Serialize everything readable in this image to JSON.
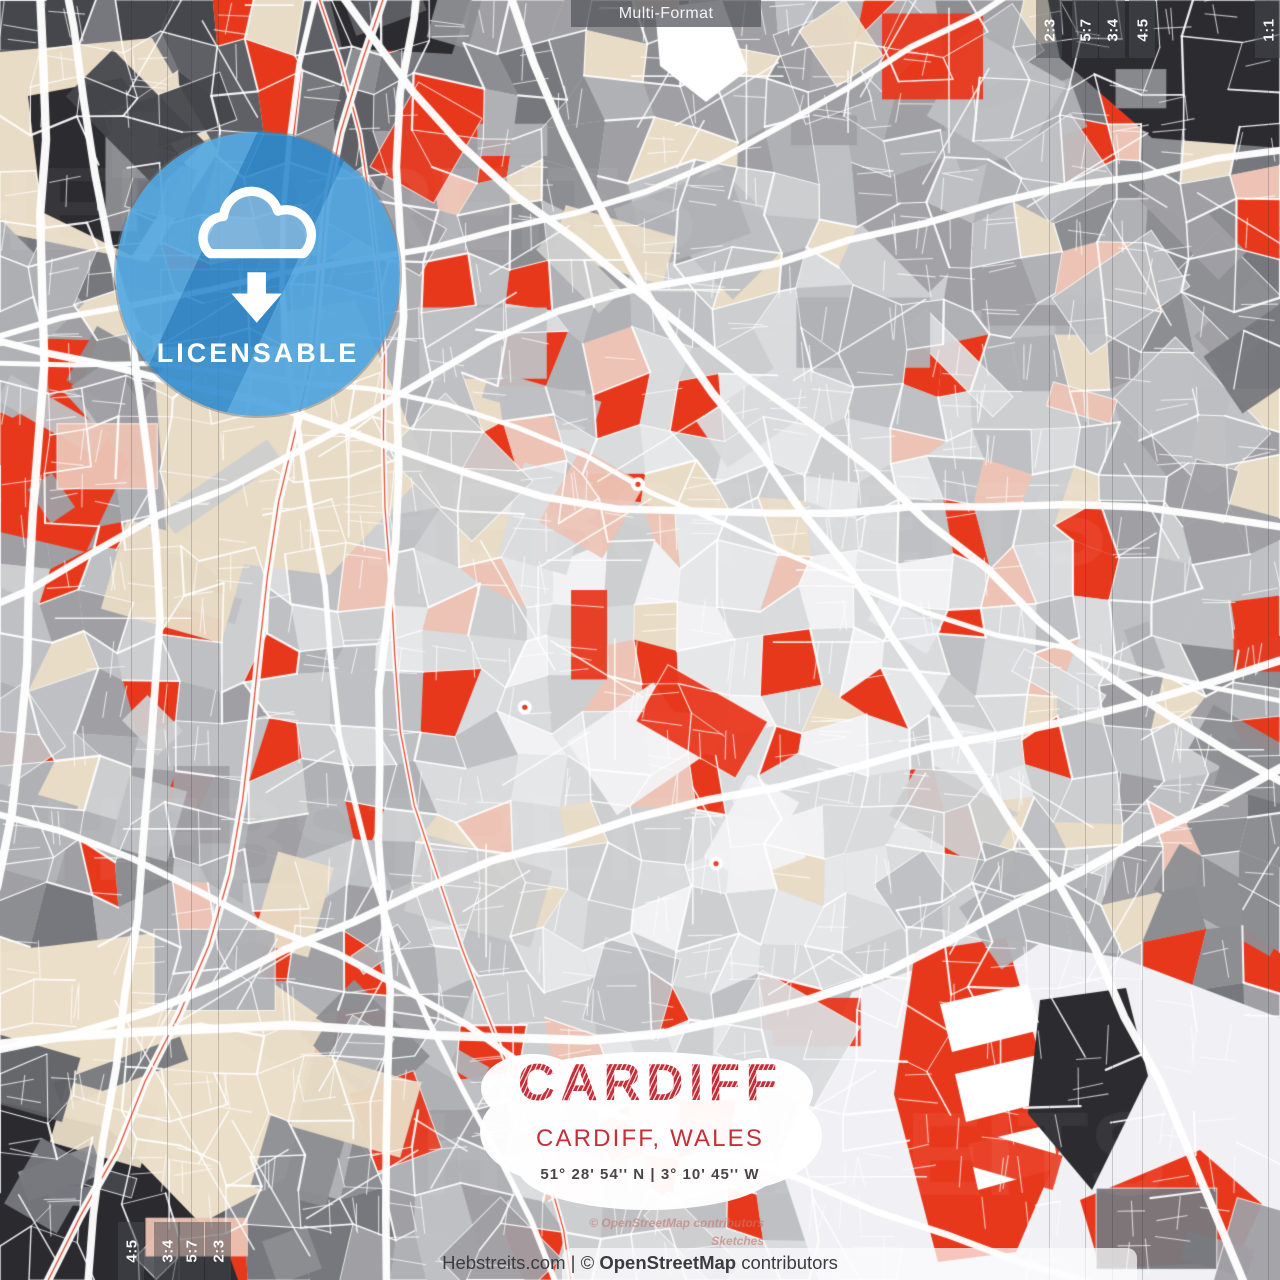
{
  "top_bar": {
    "label": "Multi-Format"
  },
  "badge": {
    "label": "LICENSABLE",
    "icon": "cloud-download-icon",
    "circle_color_rgba": "rgba(50,145,212,0.87)"
  },
  "title_block": {
    "title": "CARDIFF",
    "subtitle": "CARDIFF, WALES",
    "coordinates": "51° 28' 54'' N | 3° 10' 45'' W",
    "accent_color": "#c4303a",
    "coords_color": "#4a4449"
  },
  "footer": {
    "site": "Hebstreits.com",
    "separator": " | ",
    "copyright_prefix": "© ",
    "copyright_brand": "OpenStreetMap",
    "copyright_suffix": " contributors"
  },
  "attribution": {
    "line1": "© OpenStreetMap contributors",
    "line2": "Sketches"
  },
  "watermark": {
    "text": "HEBSTREITS"
  },
  "crop_guides": {
    "right": [
      {
        "label": "2:3",
        "x": 1049
      },
      {
        "label": "5:7",
        "x": 1085
      },
      {
        "label": "3:4",
        "x": 1112
      },
      {
        "label": "4:5",
        "x": 1142
      },
      {
        "label": "1:1",
        "x": 1268
      }
    ],
    "left": [
      {
        "label": "4:5",
        "x": 131
      },
      {
        "label": "3:4",
        "x": 167
      },
      {
        "label": "5:7",
        "x": 191
      },
      {
        "label": "2:3",
        "x": 218
      }
    ]
  },
  "map": {
    "seed": 11,
    "base": "#d4d5d7",
    "grid": 30,
    "jitter": 30,
    "p_red": 0.085,
    "p_warm": 0.1,
    "palette": {
      "red": "#e8381c",
      "beige": "#e9dcc6",
      "pink": "#ecc3b4",
      "street": "#ffffff",
      "grays": [
        "#ffffff",
        "#f2f2f4",
        "#e6e7e9",
        "#dadbdd",
        "#cdcecf",
        "#bfc0c3",
        "#b0b1b5",
        "#a09fa4",
        "#8d8e92",
        "#77787d",
        "#5f6065",
        "#46474c",
        "#2c2c31"
      ]
    },
    "macro": [
      {
        "c": "#e9dcc6",
        "p": [
          [
            0,
            52
          ],
          [
            152,
            38
          ],
          [
            218,
            152
          ],
          [
            148,
            262
          ],
          [
            0,
            232
          ]
        ]
      },
      {
        "c": "#2b2b30",
        "p": [
          [
            28,
            96
          ],
          [
            122,
            78
          ],
          [
            188,
            168
          ],
          [
            132,
            256
          ],
          [
            42,
            212
          ]
        ]
      },
      {
        "c": "#2b2b30",
        "p": [
          [
            330,
            0
          ],
          [
            470,
            0
          ],
          [
            452,
            54
          ],
          [
            342,
            48
          ]
        ]
      },
      {
        "c": "#ffffff",
        "p": [
          [
            655,
            8
          ],
          [
            722,
            0
          ],
          [
            748,
            70
          ],
          [
            706,
            102
          ],
          [
            660,
            66
          ]
        ]
      },
      {
        "c": "#2b2b30",
        "p": [
          [
            1048,
            0
          ],
          [
            1280,
            0
          ],
          [
            1280,
            148
          ],
          [
            1152,
            138
          ],
          [
            1060,
            58
          ]
        ]
      },
      {
        "c": "#e9dcc6",
        "p": [
          [
            152,
            335
          ],
          [
            355,
            300
          ],
          [
            428,
            470
          ],
          [
            330,
            575
          ],
          [
            168,
            555
          ]
        ]
      },
      {
        "c": "#e8381c",
        "p": [
          [
            0,
            425
          ],
          [
            62,
            390
          ],
          [
            128,
            462
          ],
          [
            86,
            552
          ],
          [
            0,
            532
          ]
        ]
      },
      {
        "c": "#ecdfca",
        "p": [
          [
            0,
            952
          ],
          [
            196,
            928
          ],
          [
            322,
            1018
          ],
          [
            286,
            1178
          ],
          [
            140,
            1256
          ],
          [
            0,
            1224
          ]
        ]
      },
      {
        "c": "#2a2a2f",
        "p": [
          [
            0,
            1102
          ],
          [
            108,
            1128
          ],
          [
            228,
            1252
          ],
          [
            238,
            1280
          ],
          [
            0,
            1280
          ]
        ]
      },
      {
        "c": "#f1f1f5",
        "p": [
          [
            852,
            992
          ],
          [
            1002,
            938
          ],
          [
            1122,
            958
          ],
          [
            1280,
            1018
          ],
          [
            1280,
            1280
          ],
          [
            818,
            1280
          ],
          [
            778,
            1158
          ]
        ]
      },
      {
        "c": "#e8381c",
        "p": [
          [
            915,
            952
          ],
          [
            1006,
            938
          ],
          [
            1064,
            1140
          ],
          [
            1016,
            1252
          ],
          [
            938,
            1262
          ],
          [
            894,
            1094
          ]
        ]
      },
      {
        "c": "#ffffff",
        "p": [
          [
            940,
            1004
          ],
          [
            1028,
            984
          ],
          [
            1040,
            1030
          ],
          [
            952,
            1052
          ]
        ]
      },
      {
        "c": "#ffffff",
        "p": [
          [
            955,
            1074
          ],
          [
            1042,
            1054
          ],
          [
            1052,
            1100
          ],
          [
            966,
            1122
          ]
        ]
      },
      {
        "c": "#ffffff",
        "p": [
          [
            968,
            1144
          ],
          [
            1052,
            1124
          ],
          [
            1058,
            1168
          ],
          [
            978,
            1190
          ]
        ]
      },
      {
        "c": "#2b2b30",
        "p": [
          [
            1040,
            1000
          ],
          [
            1126,
            988
          ],
          [
            1148,
            1076
          ],
          [
            1092,
            1190
          ],
          [
            1028,
            1114
          ]
        ]
      },
      {
        "c": "#e8381c",
        "p": [
          [
            1080,
            1200
          ],
          [
            1200,
            1150
          ],
          [
            1262,
            1204
          ],
          [
            1236,
            1262
          ],
          [
            1100,
            1268
          ]
        ]
      }
    ]
  }
}
